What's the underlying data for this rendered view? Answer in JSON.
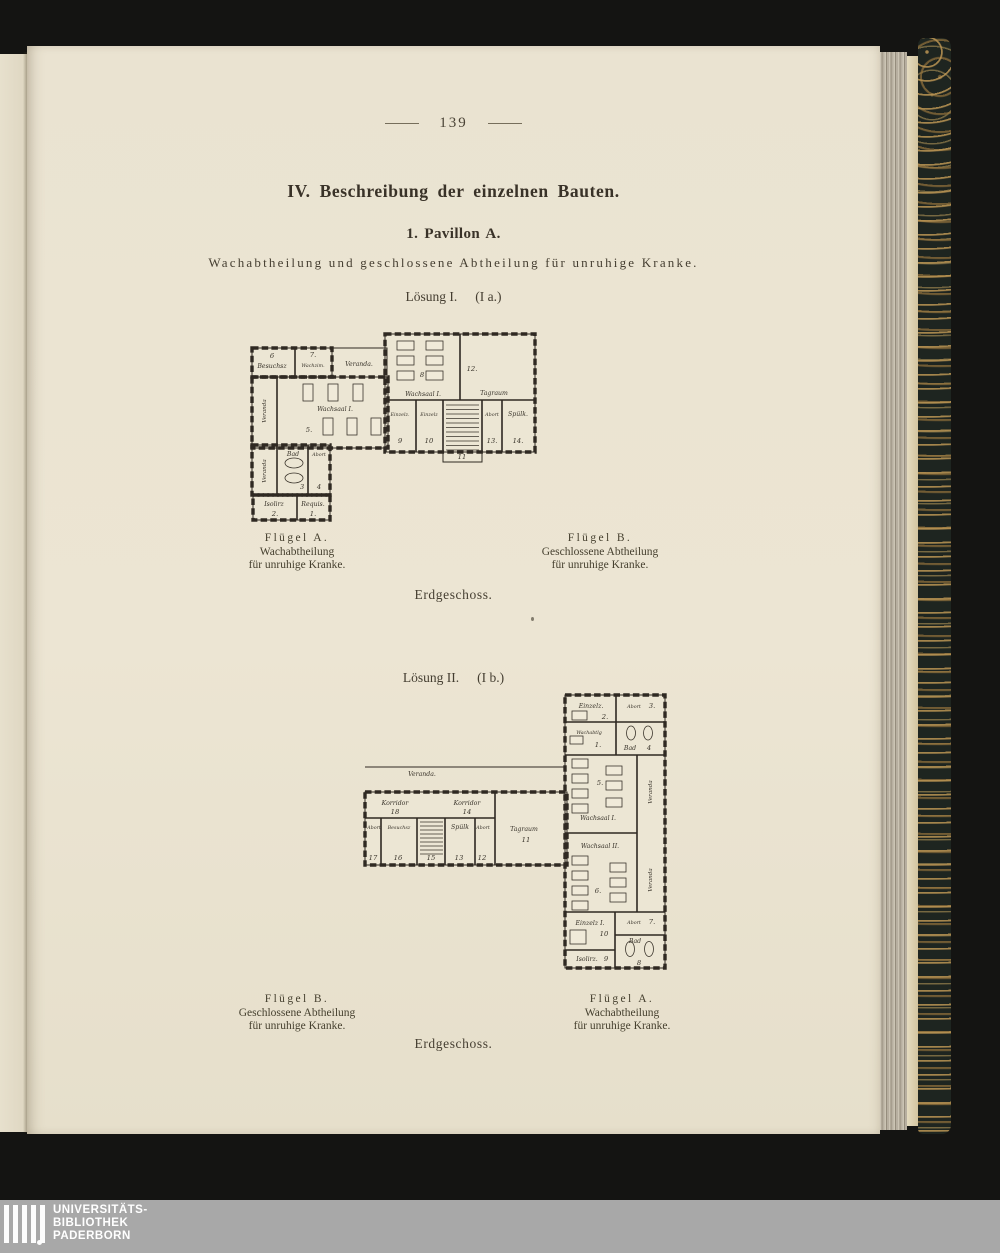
{
  "scan": {
    "page_number": "139",
    "section_title": "IV. Beschreibung der einzelnen Bauten.",
    "subsection_title": "1. Pavillon A.",
    "subtitle": "Wachabtheilung und geschlossene Abtheilung für unruhige Kranke.",
    "solution1": {
      "name": "Lösung I.",
      "variant": "(I a.)"
    },
    "solution2": {
      "name": "Lösung II.",
      "variant": "(I b.)"
    },
    "floor_label": "Erdgeschoss."
  },
  "captions": {
    "fluegel_a": {
      "l1": "Flügel A.",
      "l2": "Wachabtheilung",
      "l3": "für unruhige Kranke."
    },
    "fluegel_b": {
      "l1": "Flügel B.",
      "l2": "Geschlossene Abtheilung",
      "l3": "für unruhige Kranke."
    }
  },
  "p1": {
    "ver_top": "Veranda.",
    "ver_left": "Veranda",
    "ver_left2": "Veranda",
    "r6n": "6",
    "r6": "Besuchsz",
    "r7n": "7.",
    "r7": "Wachzim.",
    "r5": "Wachsaal I.",
    "r5n": "5.",
    "r3": "Bad",
    "r3n": "3",
    "r4": "Abort",
    "r4n": "4",
    "r2": "Isolirz",
    "r2n": "2.",
    "r1": "Requis.",
    "r1n": "1.",
    "r8": "Wachsaal I.",
    "r8n": "8",
    "r12": "Tagraum",
    "r12n": "12.",
    "r9": "Einzelz.",
    "r9n": "9",
    "r10": "Einzelz",
    "r10n": "10",
    "r11n": "11",
    "r13": "Abort",
    "r13n": "13.",
    "r14": "Spülk.",
    "r14n": "14."
  },
  "p2": {
    "ver_top": "Veranda.",
    "kor18": "Korridor",
    "kor18n": "18",
    "kor14": "Korridor",
    "kor14n": "14",
    "r17": "Abort",
    "r17n": "17",
    "r16": "Besuchsz",
    "r16n": "16",
    "r15n": "15",
    "r13": "Spülk",
    "r13n": "13",
    "r12": "Abort",
    "r12n": "12",
    "r11": "Tagraum",
    "r11n": "11",
    "r2": "Einzelz.",
    "r2n": "2.",
    "r3": "Abort",
    "r3n": "3.",
    "r1": "Wachabtlg",
    "r1n": "1.",
    "r4": "Bad",
    "r4n": "4",
    "r5": "Wachsaal I.",
    "r5n": "5.",
    "ver_r1": "Veranda",
    "r6": "Wachsaal II.",
    "r6n": "6.",
    "ver_r2": "Veranda",
    "r10": "Einzelz I.",
    "r10n": "10",
    "r7": "Abort",
    "r7n": "7.",
    "r9": "Isolirz.",
    "r9n": "9",
    "r8": "Bad",
    "r8n": "8"
  },
  "banner": {
    "l1": "UNIVERSITÄTS-",
    "l2": "BIBLIOTHEK",
    "l3": "PADERBORN"
  }
}
